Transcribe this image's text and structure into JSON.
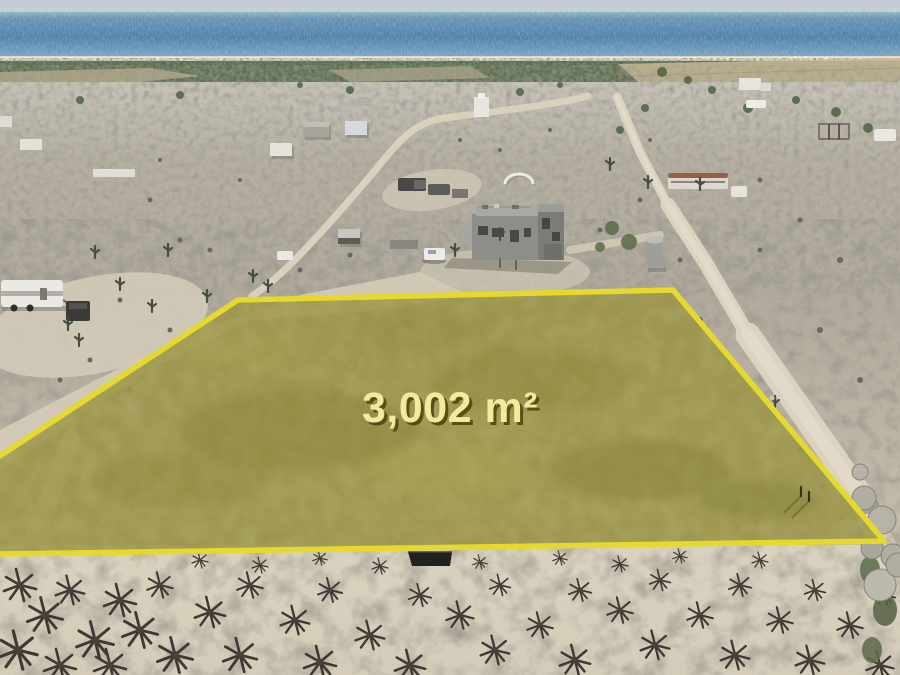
{
  "scene": {
    "description": "Aerial drone photo of a desert community by the ocean with a highlighted land parcel outlined in yellow",
    "parcel": {
      "area_label": "3,002 m²",
      "fill_color": "#9a9340",
      "outline_color": "#e6d92d",
      "label_color": "#f0eb9e",
      "label_shadow_color": "#555016"
    },
    "environment": {
      "sky_color": "#c4cdd3",
      "ocean_color": "#4e82ab",
      "beach_color": "#ddd6c6",
      "vegetation_color": "#5a694c",
      "desert_color": "#b3ac9e",
      "road_color": "#dbd3c0",
      "foreground_sand_color": "#d8d1be"
    }
  }
}
